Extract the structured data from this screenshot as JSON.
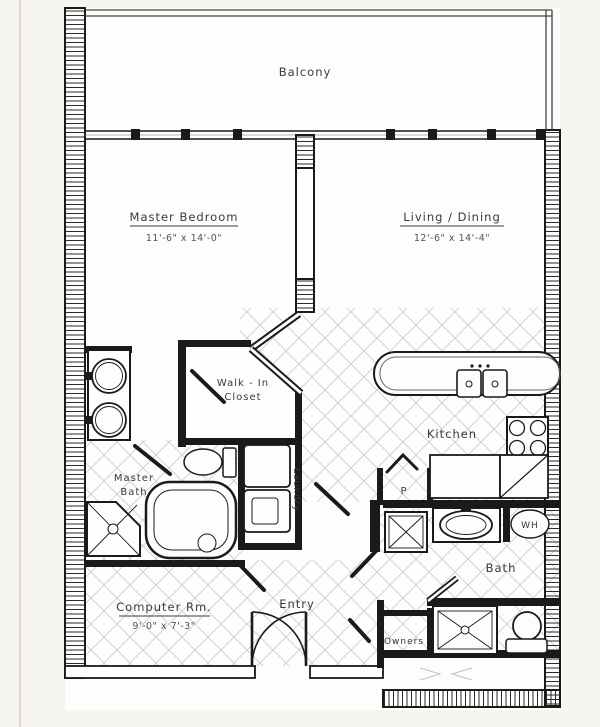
{
  "plan_title": "Condominium Unit Floor Plan",
  "colors": {
    "paper": "#f6f5f1",
    "interior": "#fdfdfb",
    "ink": "#1a1a1a",
    "label_ink": "#3a3a3a",
    "tile_line": "#c9c9c9",
    "scan_artifact_pink": "#e6c6c6"
  },
  "labels": {
    "balcony": "Balcony",
    "master_bedroom": "Master Bedroom",
    "master_bedroom_dims": "11'-6\" x 14'-0\"",
    "living_dining": "Living / Dining",
    "living_dining_dims": "12'-6\" x 14'-4\"",
    "walk_in_line1": "Walk - In",
    "walk_in_line2": "Closet",
    "kitchen": "Kitchen",
    "master_bath_line1": "Master",
    "master_bath_line2": "Bath",
    "laundry": "Laundry",
    "pantry": "P",
    "bath": "Bath",
    "water_heater": "WH",
    "computer_room": "Computer Rm.",
    "computer_room_dims": "9'-0\" x 7'-3\"",
    "entry": "Entry",
    "owners": "Owners"
  }
}
